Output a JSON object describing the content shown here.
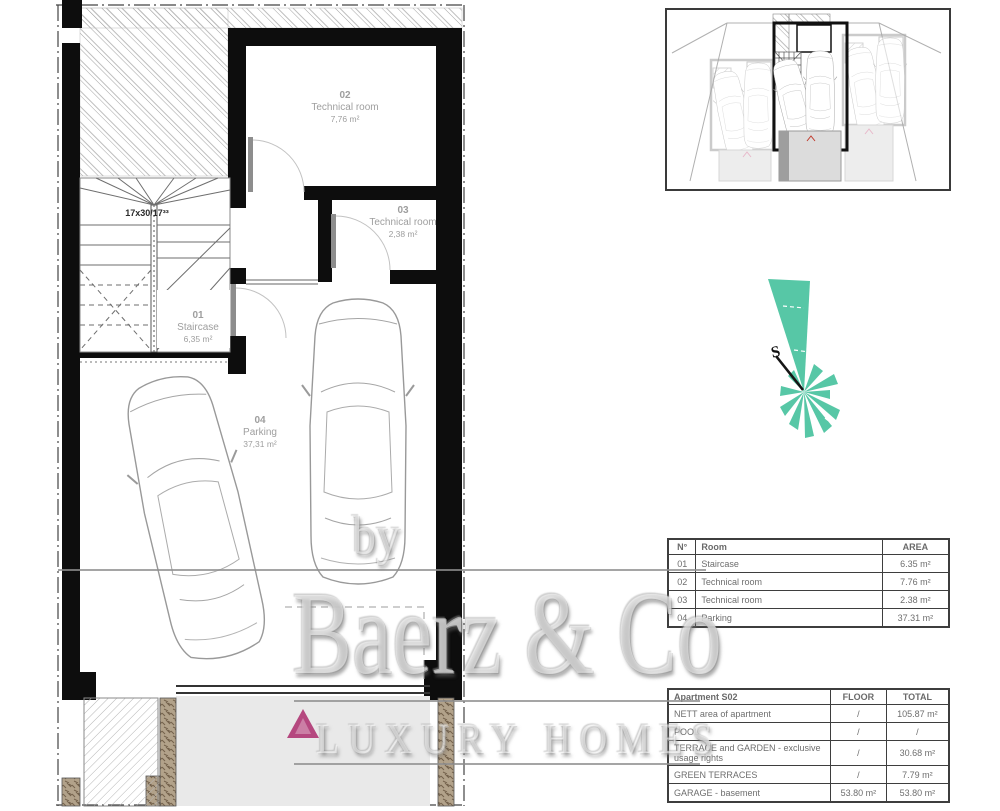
{
  "plan": {
    "stair_note": "17x30/17³³",
    "rooms": [
      {
        "num": "01",
        "name": "Staircase",
        "area": "6,35 m²"
      },
      {
        "num": "02",
        "name": "Technical room",
        "area": "7,76 m²"
      },
      {
        "num": "03",
        "name": "Technical room",
        "area": "2,38 m²"
      },
      {
        "num": "04",
        "name": "Parking",
        "area": "37,31 m²"
      }
    ]
  },
  "compass": {
    "label": "S"
  },
  "room_table": {
    "headers": [
      "N°",
      "Room",
      "AREA"
    ],
    "rows": [
      [
        "01",
        "Staircase",
        "6.35 m²"
      ],
      [
        "02",
        "Technical room",
        "7.76 m²"
      ],
      [
        "03",
        "Technical room",
        "2.38 m²"
      ],
      [
        "04",
        "Parking",
        "37.31 m²"
      ]
    ]
  },
  "summary_table": {
    "title": "Apartment S02",
    "col_headers": [
      "FLOOR",
      "TOTAL"
    ],
    "rows": [
      {
        "label": "NETT area of apartment",
        "floor": "/",
        "total": "105.87 m²"
      },
      {
        "label": "POOL",
        "floor": "/",
        "total": "/"
      },
      {
        "label": "TERRACE and GARDEN - exclusive usage rights",
        "floor": "/",
        "total": "30.68 m²"
      },
      {
        "label": "GREEN TERRACES",
        "floor": "/",
        "total": "7.79 m²"
      },
      {
        "label": "GARAGE - basement",
        "floor": "53.80 m²",
        "total": "53.80 m²"
      }
    ]
  },
  "watermark": {
    "prefix": "by",
    "brand": "Baerz & Co",
    "tagline": "LUXURY HOMES"
  },
  "colors": {
    "accent_teal": "#57c7a6",
    "logo_pink": "#b5487f",
    "wall_black": "#0d0d0d",
    "line_gray": "#9a9a9a",
    "label_gray": "#9e9e9e",
    "driveway_gray": "#e9e9e9"
  }
}
